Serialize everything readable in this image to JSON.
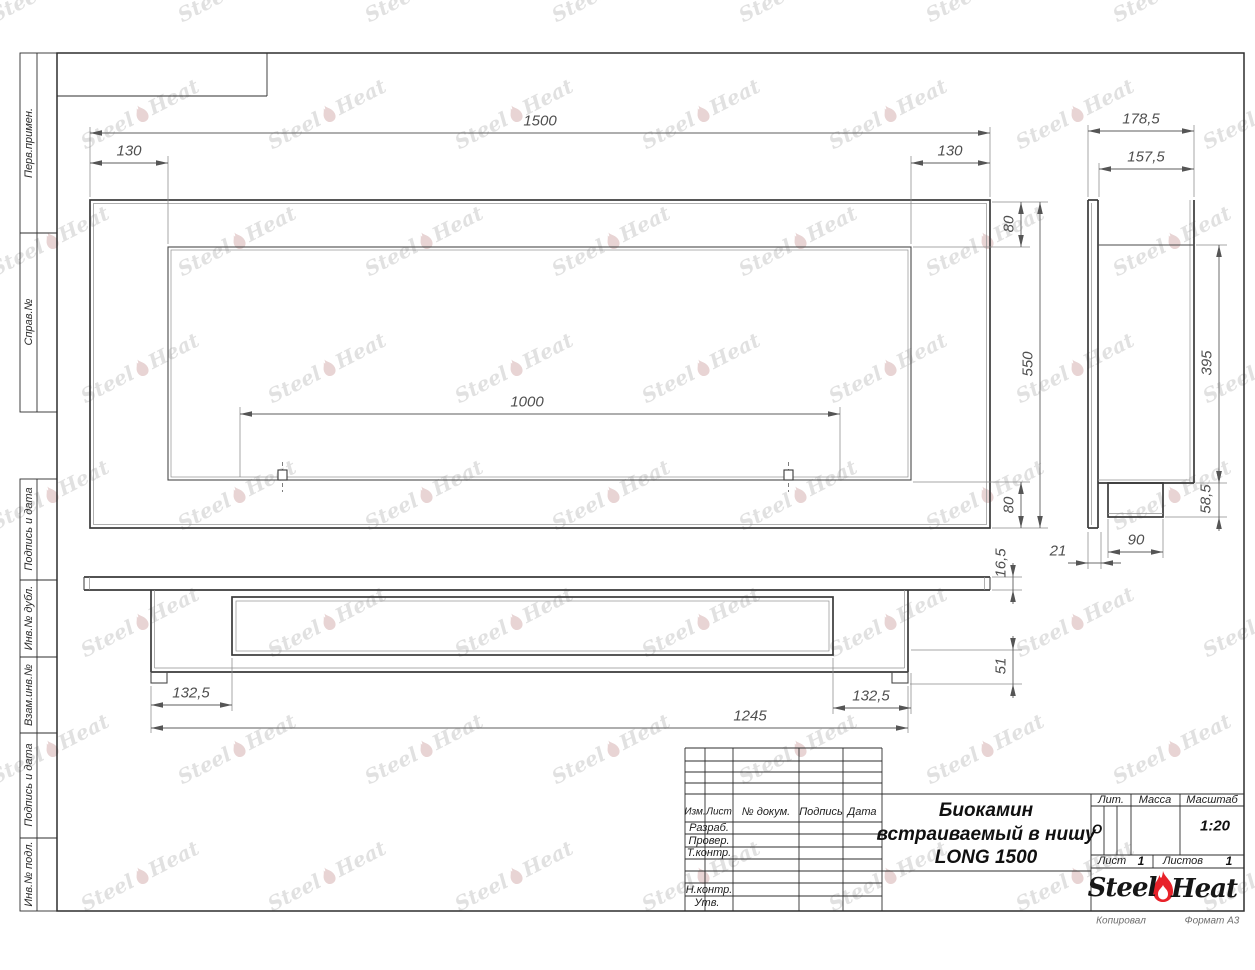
{
  "sheet": {
    "side_labels": [
      "Перв.примен.",
      "Справ.№",
      "Подпись и дата",
      "Инв.№ дубл.",
      "Взам.инв.№",
      "Подпись и дата",
      "Инв.№ подл."
    ],
    "footer": {
      "copied": "Копировал",
      "format": "Формат А3"
    }
  },
  "views": {
    "front": {
      "dims": {
        "total_width": "1500",
        "left_inset": "130",
        "right_inset": "130",
        "top_frame": "80",
        "height": "550",
        "bottom_frame": "80",
        "burner_span": "1000"
      }
    },
    "side": {
      "dims": {
        "total_depth": "178,5",
        "body_depth": "157,5",
        "niche_height": "395",
        "bottom_box_height": "58,5",
        "bottom_box_width": "90",
        "flange_depth": "21"
      }
    },
    "bottom": {
      "dims": {
        "flange_thickness": "16,5",
        "tray_depth": "51",
        "left_offset": "132,5",
        "right_offset": "132,5",
        "body_width": "1245"
      }
    }
  },
  "title_block": {
    "header_cols": [
      "Изм.",
      "Лист",
      "№ докум.",
      "Подпись",
      "Дата"
    ],
    "rows": [
      "Разраб.",
      "Провер.",
      "Т.контр.",
      "Н.контр.",
      "Утв."
    ],
    "title_lines": [
      "Биокамин",
      "встраиваемый в нишу",
      "LONG 1500"
    ],
    "lit_label": "Лит.",
    "lit_value": "О",
    "mass_label": "Масса",
    "scale_label": "Масштаб",
    "scale_value": "1:20",
    "sheet_label": "Лист",
    "sheet_value": "1",
    "sheets_label": "Листов",
    "sheets_value": "1",
    "logo": {
      "part1": "Steel",
      "part2": "Heat"
    }
  },
  "watermark": {
    "text1": "Steel",
    "text2": "Heat"
  },
  "colors": {
    "line": "#3a3a3a",
    "dim": "#5e5e5e",
    "accent_red": "#e8222a"
  }
}
